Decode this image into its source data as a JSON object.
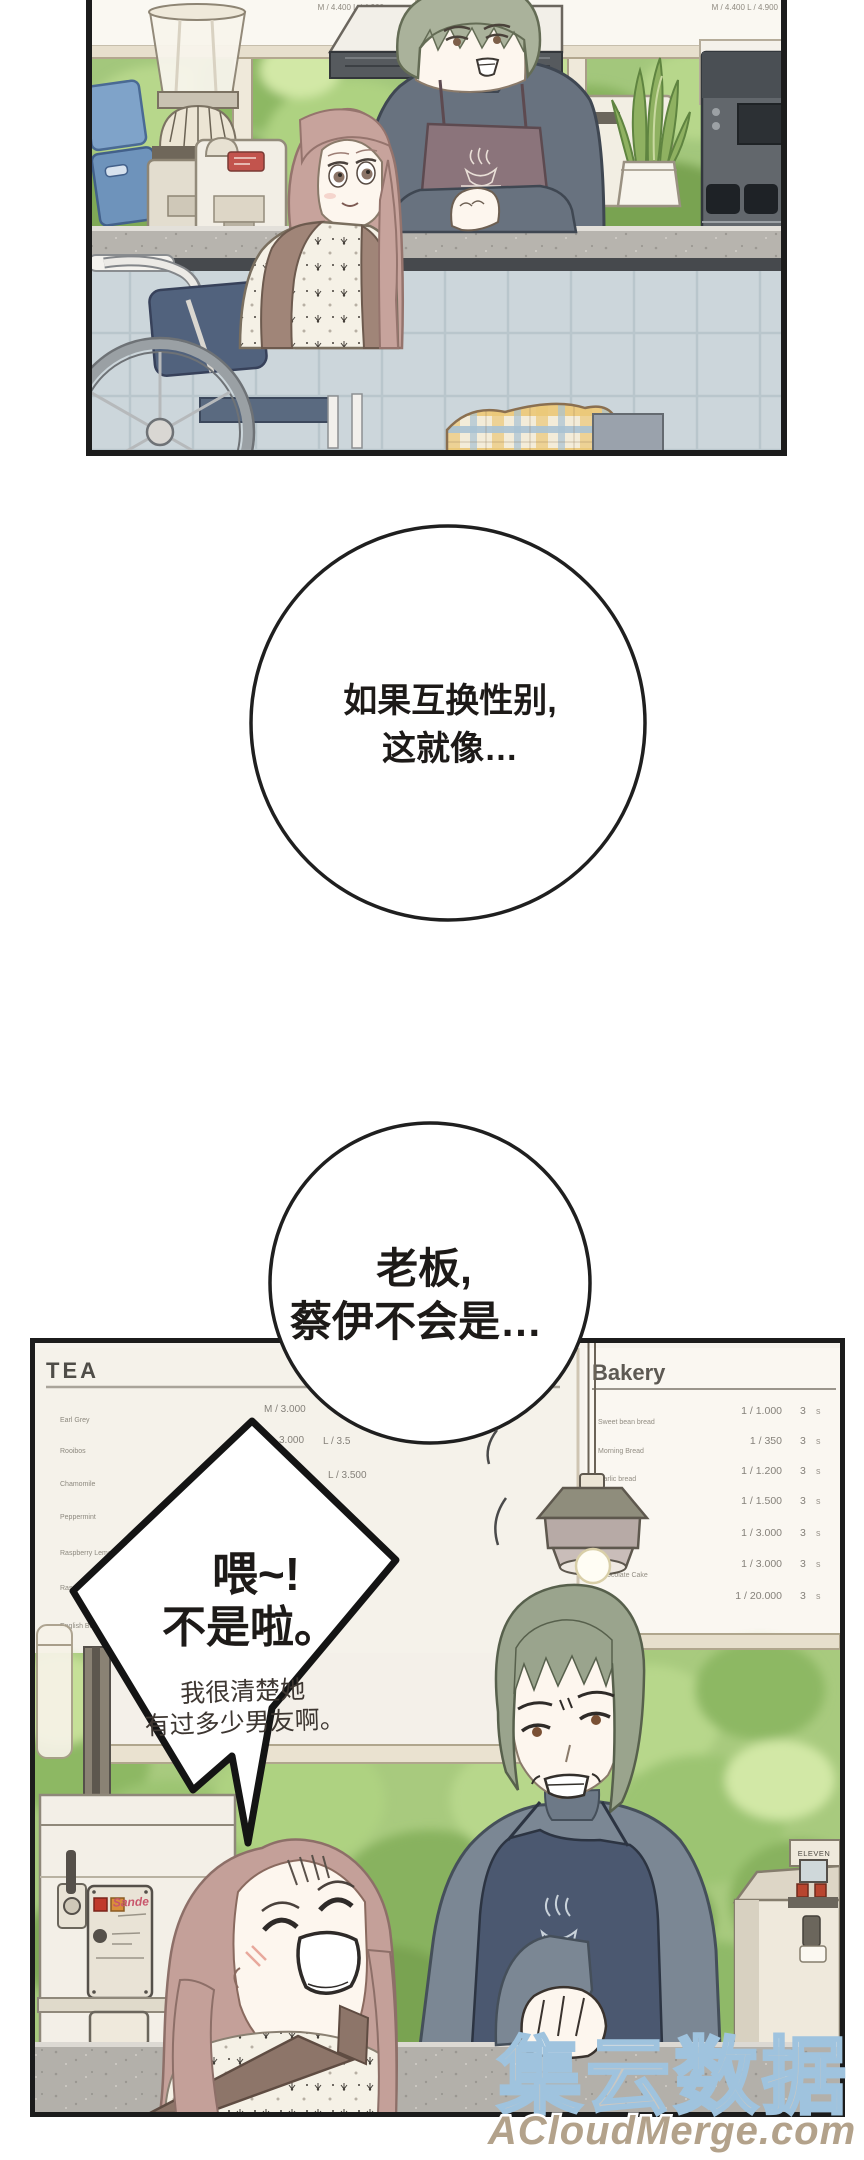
{
  "page": {
    "width": 864,
    "height": 2160,
    "background": "#ffffff"
  },
  "bubbles": {
    "thought_top": {
      "lines": [
        "如果互换性别,",
        "这就像…"
      ]
    },
    "thought_mid": {
      "lines": [
        "老板,",
        "蔡伊不会是…"
      ]
    },
    "shout": {
      "lines": [
        "喂~!",
        "不是啦。"
      ],
      "sub": [
        "我很清楚她",
        "有过多少男友啊。"
      ]
    }
  },
  "top_panel": {
    "board_left_price": "M / 4.400   L / 4.900",
    "board_right_item": "English Breakfast",
    "board_right_price": "M / 4.400   L / 4.900",
    "apron_logo": "Coffee"
  },
  "bottom_panel": {
    "tea": {
      "title": "TEA",
      "items": [
        "Earl Grey",
        "Rooibos",
        "Chamomile",
        "Peppermint",
        "Raspberry Lemon",
        "Rasp",
        "English Bre"
      ],
      "prices": [
        "M / 3.000",
        "3.000",
        "L / 3.5",
        "L / 3.500"
      ]
    },
    "bakery": {
      "title": "Bakery",
      "items": [
        "Sweet bean bread",
        "Morning Bread",
        "Garlic bread",
        "Chocolate Cake"
      ],
      "prices": [
        "1 / 1.000",
        "1 / 350",
        "1 / 1.200",
        "1 / 1.500",
        "1 / 3.000",
        "1 / 3.000",
        "1 / 20.000"
      ],
      "sizes": [
        "3",
        "3",
        "3",
        "3",
        "3",
        "3",
        "3"
      ],
      "size_suffix": "s"
    },
    "espresso_label": "Sande",
    "boiler_label": "ELEVEN",
    "apron_logo": "Coffee"
  },
  "watermark": {
    "cjk": "集云数据",
    "url": "ACloudMerge.com"
  },
  "colors": {
    "panel_border": "#1c1c1c",
    "tree_green": "#a8ca7e",
    "counter_marble": "#b3b0aa",
    "tile_blue": "#ccd6db",
    "apron_top_panel": "#8b747b",
    "apron_bottom_panel": "#4b5870",
    "barista_hair": "#9aa48d",
    "woman_hair": "#c4a099",
    "watermark_outline": "#9fc3de",
    "watermark_url_color": "#b3a28b"
  }
}
